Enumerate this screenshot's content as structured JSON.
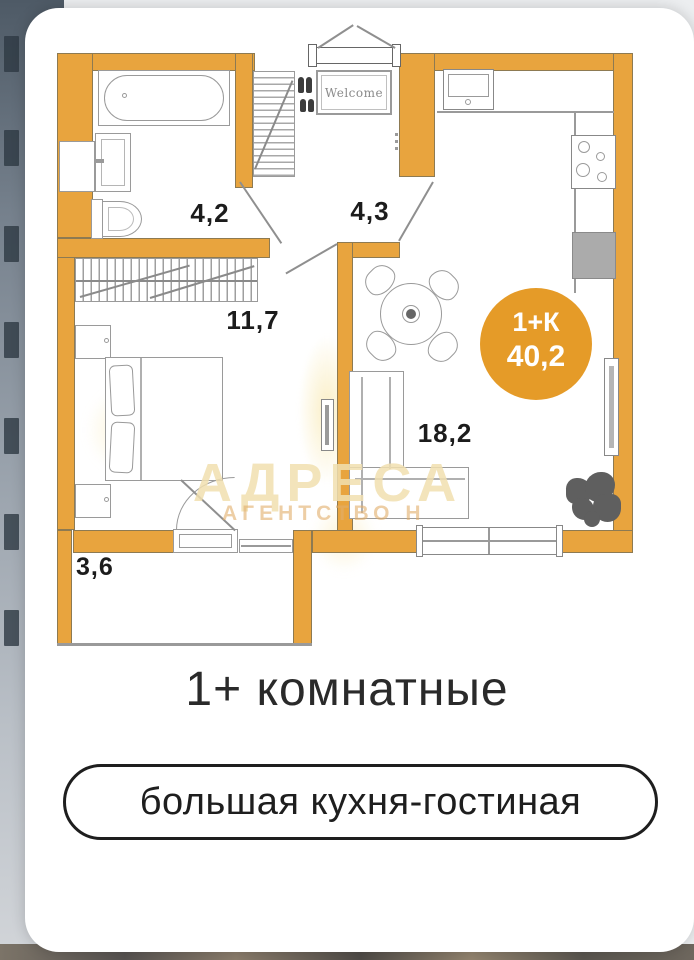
{
  "caption": {
    "title": "1+ комнатные",
    "pill": "большая кухня-гостиная"
  },
  "plan": {
    "room_areas": {
      "bathroom": "4,2",
      "hallway": "4,3",
      "bedroom": "11,7",
      "living_kitchen": "18,2",
      "balcony": "3,6"
    },
    "badge": {
      "type": "1+К",
      "area": "40,2"
    },
    "door_mat": "Welcome",
    "watermark": {
      "name": "АДРЕСА",
      "subtitle": "АГЕНТСТВО Н"
    }
  },
  "colors": {
    "wall": "#E8A43E",
    "wall-line": "#8D7A52",
    "badge": "#E59B28",
    "line": "#9A9A9A",
    "fridge": "#ABABAB",
    "plant": "#5F5F5F",
    "label": "#1C1C1C",
    "text": "#2A2A2A",
    "wm-big": "#F1E0B0",
    "wm-small": "#E2AE6B"
  }
}
